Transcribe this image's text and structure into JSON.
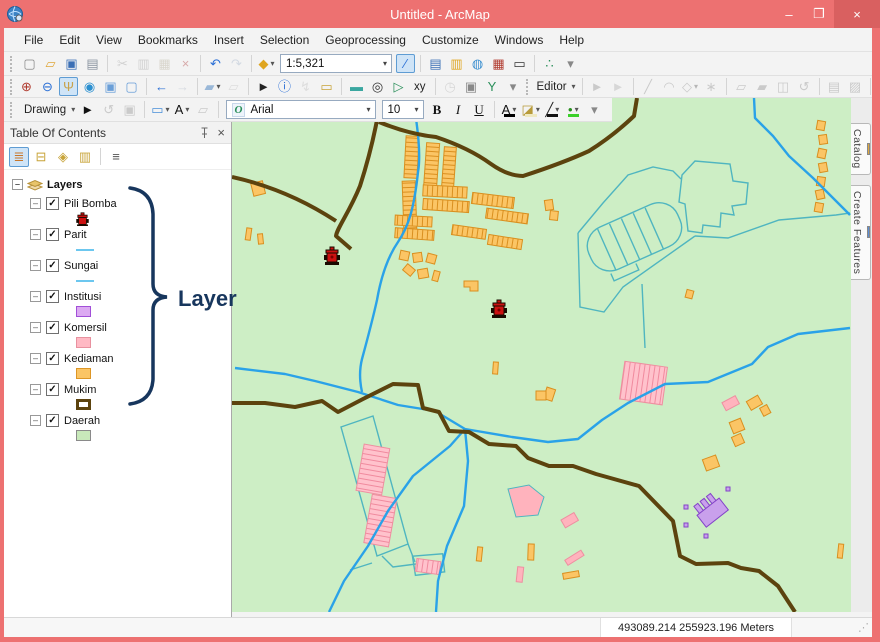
{
  "window": {
    "title": "Untitled - ArcMap",
    "controls": {
      "minimize": "–",
      "maximize": "❐",
      "close": "×"
    },
    "colors": {
      "titlebar": "#ed7171"
    }
  },
  "menu": {
    "items": [
      "File",
      "Edit",
      "View",
      "Bookmarks",
      "Insert",
      "Selection",
      "Geoprocessing",
      "Customize",
      "Windows",
      "Help"
    ]
  },
  "scale": {
    "value": "1:5,321"
  },
  "font": {
    "name": "Arial",
    "size": "10"
  },
  "toolbars": {
    "standard_left": [
      {
        "n": "new-map-button",
        "g": "▢",
        "c": "#8a8a8a"
      },
      {
        "n": "open-button",
        "g": "▱",
        "c": "#e0a83c"
      },
      {
        "n": "save-button",
        "g": "▣",
        "c": "#3b6fb5"
      },
      {
        "n": "print-button",
        "g": "▤",
        "c": "#8a94a0"
      },
      {
        "sep": true
      },
      {
        "n": "cut-button",
        "g": "✂",
        "c": "#999999",
        "gray": true
      },
      {
        "n": "copy-button",
        "g": "▥",
        "c": "#999999",
        "gray": true
      },
      {
        "n": "paste-button",
        "g": "▦",
        "c": "#b0a890",
        "gray": true
      },
      {
        "n": "delete-button",
        "g": "×",
        "c": "#aa3333",
        "gray": true
      },
      {
        "sep": true
      },
      {
        "n": "undo-button",
        "g": "↶",
        "c": "#2a6fd6"
      },
      {
        "n": "redo-button",
        "g": "↷",
        "c": "#9fb0c8",
        "gray": true
      },
      {
        "sep": true
      },
      {
        "n": "add-data-button",
        "g": "◆",
        "c": "#dfa51f",
        "dd": true
      }
    ],
    "standard_right": [
      {
        "n": "editor-toolbar-toggle-button",
        "g": "∕",
        "c": "#2a6fd6",
        "sel": true
      },
      {
        "sep": true
      },
      {
        "n": "table-of-contents-window-button",
        "g": "▤",
        "c": "#3b6fb5"
      },
      {
        "n": "catalog-window-button",
        "g": "▥",
        "c": "#dfa51f"
      },
      {
        "n": "search-window-button",
        "g": "◍",
        "c": "#3b8fd0"
      },
      {
        "n": "arctoolbox-window-button",
        "g": "▦",
        "c": "#b03a2e"
      },
      {
        "n": "python-window-button",
        "g": "▭",
        "c": "#333333"
      },
      {
        "sep": true
      },
      {
        "n": "modelbuilder-button",
        "g": "∴",
        "c": "#2a8f5a"
      },
      {
        "n": "toolbar-overflow-button",
        "g": "▾",
        "c": "#888888"
      }
    ],
    "tools": [
      {
        "n": "zoom-in-button",
        "g": "⊕",
        "c": "#b03a2e"
      },
      {
        "n": "zoom-out-button",
        "g": "⊖",
        "c": "#2a6fd6"
      },
      {
        "n": "pan-button",
        "g": "Ψ",
        "c": "#c8a24b",
        "sel": true
      },
      {
        "n": "full-extent-button",
        "g": "◉",
        "c": "#2a8fd0"
      },
      {
        "n": "fixed-zoom-in-button",
        "g": "▣",
        "c": "#6a9fd8"
      },
      {
        "n": "fixed-zoom-out-button",
        "g": "▢",
        "c": "#6a9fd8"
      },
      {
        "sep": true
      },
      {
        "n": "go-back-extent-button",
        "g": "←",
        "c": "#2a6fd6"
      },
      {
        "n": "go-forward-extent-button",
        "g": "→",
        "c": "#a8b4c4",
        "gray": true
      },
      {
        "sep": true
      },
      {
        "n": "select-features-button",
        "g": "▰",
        "c": "#9ab8d8",
        "dd": true
      },
      {
        "n": "clear-selected-features-button",
        "g": "▱",
        "c": "#bbbbbb",
        "gray": true
      },
      {
        "sep": true
      },
      {
        "n": "select-elements-button",
        "g": "►",
        "c": "#222222"
      },
      {
        "n": "identify-button",
        "g": "ⓘ",
        "c": "#2a6fd6"
      },
      {
        "n": "hyperlink-button",
        "g": "↯",
        "c": "#bbbbbb",
        "gray": true
      },
      {
        "n": "html-popup-button",
        "g": "▭",
        "c": "#c8a43a"
      },
      {
        "sep": true
      },
      {
        "n": "measure-button",
        "g": "▬",
        "c": "#3aa7a0"
      },
      {
        "n": "find-button",
        "g": "◎",
        "c": "#333333"
      },
      {
        "n": "find-route-button",
        "g": "▷",
        "c": "#2a8f5a"
      },
      {
        "n": "go-to-xy-button",
        "lbl": "xy"
      },
      {
        "sep": true
      },
      {
        "n": "time-slider-button",
        "g": "◷",
        "c": "#aaaaaa",
        "gray": true
      },
      {
        "n": "viewer-window-button",
        "g": "▣",
        "c": "#888888"
      },
      {
        "n": "walk-button",
        "g": "Y",
        "c": "#2a8f5a"
      },
      {
        "n": "tools-overflow-button",
        "g": "▾",
        "c": "#888888"
      }
    ],
    "editor": [
      {
        "n": "editor-menu-button",
        "lbl": "Editor",
        "dd": true
      },
      {
        "sep": true
      },
      {
        "n": "edit-tool-button",
        "g": "►",
        "c": "#888888",
        "gray": true
      },
      {
        "n": "edit-annotation-tool-button",
        "g": "►",
        "c": "#aaaaaa",
        "gray": true
      },
      {
        "sep": true
      },
      {
        "n": "straight-segment-button",
        "g": "╱",
        "c": "#888888",
        "gray": true
      },
      {
        "n": "endpoint-arc-button",
        "g": "◠",
        "c": "#888888",
        "gray": true
      },
      {
        "n": "trace-button",
        "g": "◇",
        "c": "#888888",
        "dd": true,
        "gray": true
      },
      {
        "n": "point-button",
        "g": "∗",
        "c": "#888888",
        "gray": true
      },
      {
        "sep": true
      },
      {
        "n": "edit-vertices-button",
        "g": "▱",
        "c": "#888888",
        "gray": true
      },
      {
        "n": "reshape-feature-button",
        "g": "▰",
        "c": "#888888",
        "gray": true
      },
      {
        "n": "cut-polygons-button",
        "g": "◫",
        "c": "#888888",
        "gray": true
      },
      {
        "n": "rotate-tool-button",
        "g": "↺",
        "c": "#888888",
        "gray": true
      },
      {
        "sep": true
      },
      {
        "n": "attributes-button",
        "g": "▤",
        "c": "#888888",
        "gray": true
      },
      {
        "n": "sketch-properties-button",
        "g": "▨",
        "c": "#888888",
        "gray": true
      },
      {
        "sep": true
      },
      {
        "n": "create-features-button",
        "g": "▧",
        "c": "#7a8898"
      },
      {
        "n": "attribute-calculator-button",
        "g": "▦",
        "c": "#b03a2e"
      },
      {
        "n": "editor-overflow-button",
        "g": "▾",
        "c": "#888888"
      }
    ],
    "drawing_left": [
      {
        "n": "drawing-menu-button",
        "lbl": "Drawing",
        "dd": true
      },
      {
        "n": "select-elements-tool-button",
        "g": "►",
        "c": "#111111"
      },
      {
        "n": "rotate-element-button",
        "g": "↺",
        "c": "#888888",
        "gray": true
      },
      {
        "n": "zoom-to-selected-button",
        "g": "▣",
        "c": "#888888",
        "gray": true
      },
      {
        "sep": true
      },
      {
        "n": "new-rectangle-button",
        "g": "▭",
        "c": "#4a90d9",
        "dd": true
      },
      {
        "n": "new-text-button",
        "g": "A",
        "c": "#111111",
        "dd": true
      },
      {
        "n": "edit-vertices-drawing-button",
        "g": "▱",
        "c": "#888888",
        "gray": true
      },
      {
        "sep": true
      }
    ],
    "drawing_right": [
      {
        "n": "bold-button",
        "g": "B",
        "c": "#111111",
        "fs": "b"
      },
      {
        "n": "italic-button",
        "g": "I",
        "c": "#111111",
        "fs": "i"
      },
      {
        "n": "underline-button",
        "g": "U",
        "c": "#111111",
        "fs": "u"
      },
      {
        "sep": true
      },
      {
        "n": "font-color-button",
        "g": "A",
        "c": "#111111",
        "bar": "#000000",
        "dd": true
      },
      {
        "n": "fill-color-button",
        "g": "◪",
        "c": "#b89b3a",
        "bar": "#efe9c0",
        "dd": true
      },
      {
        "n": "line-color-button",
        "g": "╱",
        "c": "#222222",
        "bar": "#111111",
        "dd": true
      },
      {
        "n": "marker-color-button",
        "g": "•",
        "c": "#2a8f20",
        "bar": "#3bd12a",
        "dd": true
      },
      {
        "n": "drawing-overflow-button",
        "g": "▾",
        "c": "#888888"
      }
    ]
  },
  "toc": {
    "title": "Table Of Contents",
    "tools": [
      {
        "n": "list-by-drawing-order-button",
        "g": "≣",
        "c": "#c8762a",
        "sel": true
      },
      {
        "n": "list-by-source-button",
        "g": "⊟",
        "c": "#c8a43a"
      },
      {
        "n": "list-by-visibility-button",
        "g": "◈",
        "c": "#c8a43a"
      },
      {
        "n": "list-by-selection-button",
        "g": "▥",
        "c": "#c8a43a"
      },
      {
        "sep": true
      },
      {
        "n": "toc-options-button",
        "g": "≡",
        "c": "#555555"
      }
    ],
    "root_label": "Layers",
    "layers": [
      {
        "name": "Pili Bomba",
        "symbol": "hydrant",
        "color": "#cc1111"
      },
      {
        "name": "Parit",
        "symbol": "line",
        "color": "#6cc7ef"
      },
      {
        "name": "Sungai",
        "symbol": "line",
        "color": "#6cc7ef"
      },
      {
        "name": "Institusi",
        "symbol": "rect",
        "fill": "#dcaaf2",
        "stroke": "#a14fd8"
      },
      {
        "name": "Komersil",
        "symbol": "rect",
        "fill": "#ffb9c4",
        "stroke": "#e8919f"
      },
      {
        "name": "Kediaman",
        "symbol": "rect",
        "fill": "#fbc565",
        "stroke": "#dd9626"
      },
      {
        "name": "Mukim",
        "symbol": "rect-outline",
        "fill": "#ffffff",
        "stroke": "#5c430e"
      },
      {
        "name": "Daerah",
        "symbol": "rect",
        "fill": "#c8e9ba",
        "stroke": "#8a8a8a"
      }
    ]
  },
  "annotation": {
    "label": "Layer",
    "color": "#17365d"
  },
  "map": {
    "colors": {
      "background": "#cdeec5",
      "mukim_boundary": "#5c430e",
      "river": "#2aa2e8",
      "drain": "#4fb5c0",
      "building_fill": "#fbc565",
      "building_stroke": "#d98f1f",
      "commercial_fill": "#ffb3bd",
      "commercial_stroke": "#ee8fa0",
      "institution_fill": "#c9a0ec",
      "institution_stroke": "#8344c8",
      "hydrant": "#cc1111"
    }
  },
  "side_tabs": [
    {
      "label": "Catalog",
      "icon": "#e0a83c"
    },
    {
      "label": "Create Features",
      "icon": "#5b8ed6"
    }
  ],
  "status": {
    "coordinates": "493089.214  255923.196 Meters"
  }
}
